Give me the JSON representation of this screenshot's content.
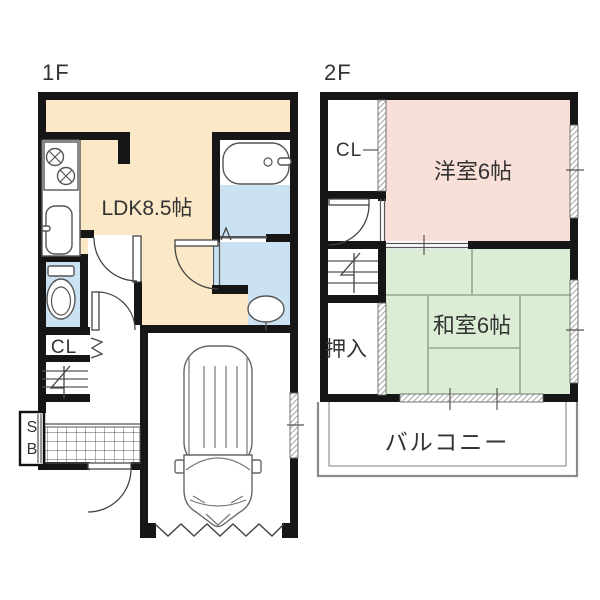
{
  "floor1": {
    "label": "1F",
    "ldk_label": "LDK8.5帖",
    "closet_label": "CL",
    "shoebox_line1": "S",
    "shoebox_line2": "B"
  },
  "floor2": {
    "label": "2F",
    "closet_label": "CL",
    "western_room_label": "洋室6帖",
    "japanese_room_label": "和室6帖",
    "oshiire_label": "押入",
    "balcony_label": "バルコニー"
  },
  "colors": {
    "ldk_floor": "#FAE8C6",
    "wet_area_floor": "#CBE2F2",
    "western_room_floor": "#F8DFD8",
    "japanese_room_floor": "#DCEDD5",
    "wall": "#161616",
    "tatami_line": "#93A893"
  }
}
